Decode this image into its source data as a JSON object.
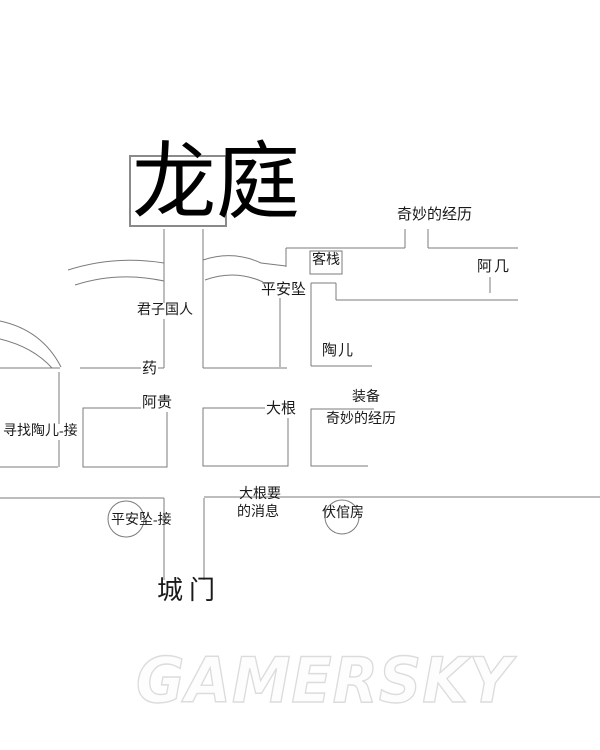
{
  "title": {
    "text": "龙庭"
  },
  "watermark": {
    "text": "GAMERSKY"
  },
  "colors": {
    "background": "#ffffff",
    "line": "#7b7b7b",
    "text": "#1a1a1a",
    "title_text": "#000000",
    "watermark_outline": "#dcdcdc"
  },
  "labels": {
    "experience_top": "奇妙的经历",
    "inn": "客栈",
    "aji": "阿几",
    "pingan_pendant": "平安坠",
    "junzi_countryman": "君子国人",
    "taoer": "陶儿",
    "medicine": "药",
    "agui": "阿贵",
    "dagen": "大根",
    "equipment": "装备",
    "experience_mid": "奇妙的经历",
    "quest_find_taoer": "寻找陶儿-接",
    "quest_pingan": "平安坠-接",
    "dagen_msg_line1": "大根要",
    "dagen_msg_line2": "的消息",
    "fuguan_room": "伏倌房",
    "city_gate": "城门"
  }
}
